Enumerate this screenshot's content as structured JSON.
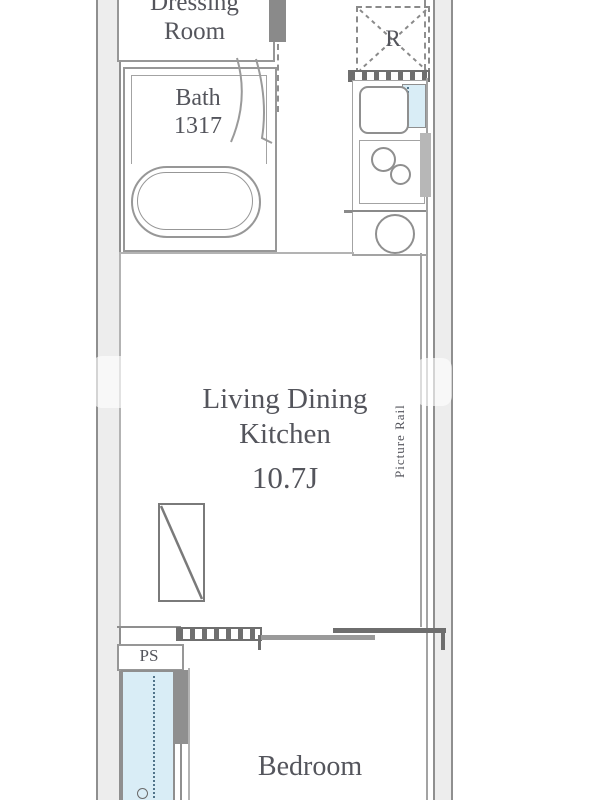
{
  "plan_title": "apartment-floor-plan",
  "labels": {
    "dressing_line1": "Dressing",
    "dressing_line2": "Room",
    "bath_name": "Bath",
    "bath_size": "1317",
    "fridge": "R",
    "ldk_line1": "Living Dining",
    "ldk_line2": "Kitchen",
    "ldk_size": "10.7J",
    "picture_rail": "Picture Rail",
    "ps": "PS",
    "bedroom": "Bedroom"
  },
  "colors": {
    "wall_line": "#8f8f8f",
    "wall_fill": "#ededed",
    "outline": "#9a9a9a",
    "text": "#54555c",
    "glass_fill": "#d9edf6",
    "glass_dot": "#51748a",
    "hatch_dark": "#6f6f6f",
    "background": "#ffffff"
  }
}
